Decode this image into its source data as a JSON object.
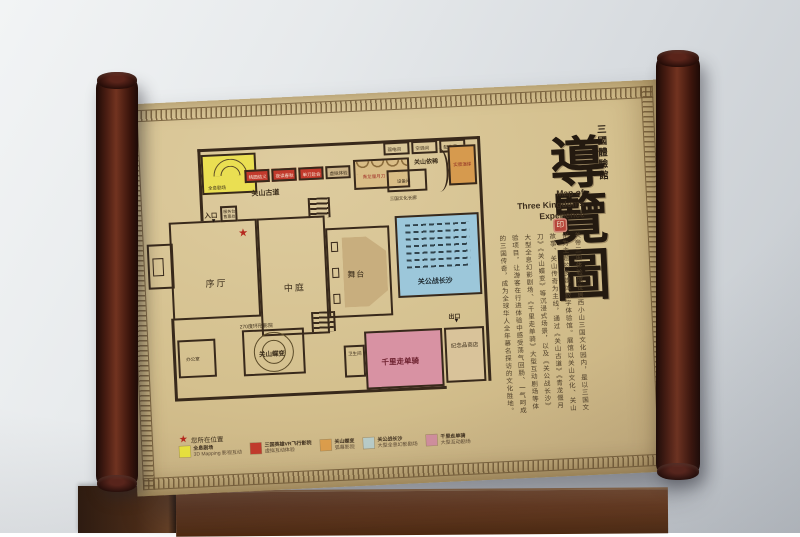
{
  "title": {
    "hall_name": "三國體驗館",
    "calligraphy": "導覽圖",
    "english_lines": [
      "Map of",
      "Three Kingdoms",
      "Experience"
    ],
    "seal_text": "印"
  },
  "description": {
    "text": "关帝三国体验馆位居西小山三国文化园内，是以三国文化为主题的多媒体数字体验馆。展馆以关山文化、关山故事、关山传奇为主线，通过《关山古道》《青龙偃月刀》《关山蝶变》等沉浸式场景，以及《关公战长沙》大型全息幻影剧场、《千里走单骑》大型互动剧场等体验项目，让游客在行进体验中感受荡气回肠、一气呵成的三国传奇，成为全球华人全年慕名探访的文化胜地。"
  },
  "floor_plan": {
    "entrance_label": "入口",
    "exit_label": "出口",
    "you_are_here_label": "您所在位置",
    "star_color": "#b5281e",
    "rooms": {
      "holo_theater": "全息剧场",
      "vr_room_1": "桃园结义",
      "vr_room_2": "夜读春秋",
      "vr_room_3": "单刀赴会",
      "vr_room_4": "虚拟体验",
      "corridor_guanshan": "关山古道",
      "sword_room": "青龙偃月刀",
      "utility_1": "弱电间",
      "utility_2": "空调间",
      "utility_3": "配电间",
      "guanshan_yixi": "关山依稀",
      "equipment": "设备间",
      "culture_corridor": "三国文化长廊",
      "scene_room": "实景演绎",
      "lobby": "序厅",
      "atrium": "中庭",
      "stage": "舞台",
      "battle_changsha": "关公战长沙",
      "ring_cinema": "270度环形影院",
      "butterfly": "关山蝶变",
      "office": "办公室",
      "restroom": "卫生间",
      "ride_alone": "千里走单骑",
      "souvenir_shop": "纪念品商店",
      "service_desk": "服务台",
      "ticket": "售票处"
    }
  },
  "legend": {
    "items": [
      {
        "name": "holo-mapping",
        "color": "#e8e23e",
        "line1": "全息剧场",
        "line2": "3D Mapping 影视互动"
      },
      {
        "name": "vr-flight",
        "color": "#c23a2c",
        "line1": "三国英雄VR飞行影院",
        "line2": "虚拟互动体验"
      },
      {
        "name": "arc-screen",
        "color": "#dd9e4b",
        "line1": "关山蝶变",
        "line2": "弧幕影院"
      },
      {
        "name": "holo-phantom",
        "color": "#b9cdc9",
        "line1": "关公战长沙",
        "line2": "大型全息幻影剧场"
      },
      {
        "name": "interactive-theater",
        "color": "#d18f9e",
        "line1": "千里走单骑",
        "line2": "大型互动剧场"
      }
    ]
  }
}
